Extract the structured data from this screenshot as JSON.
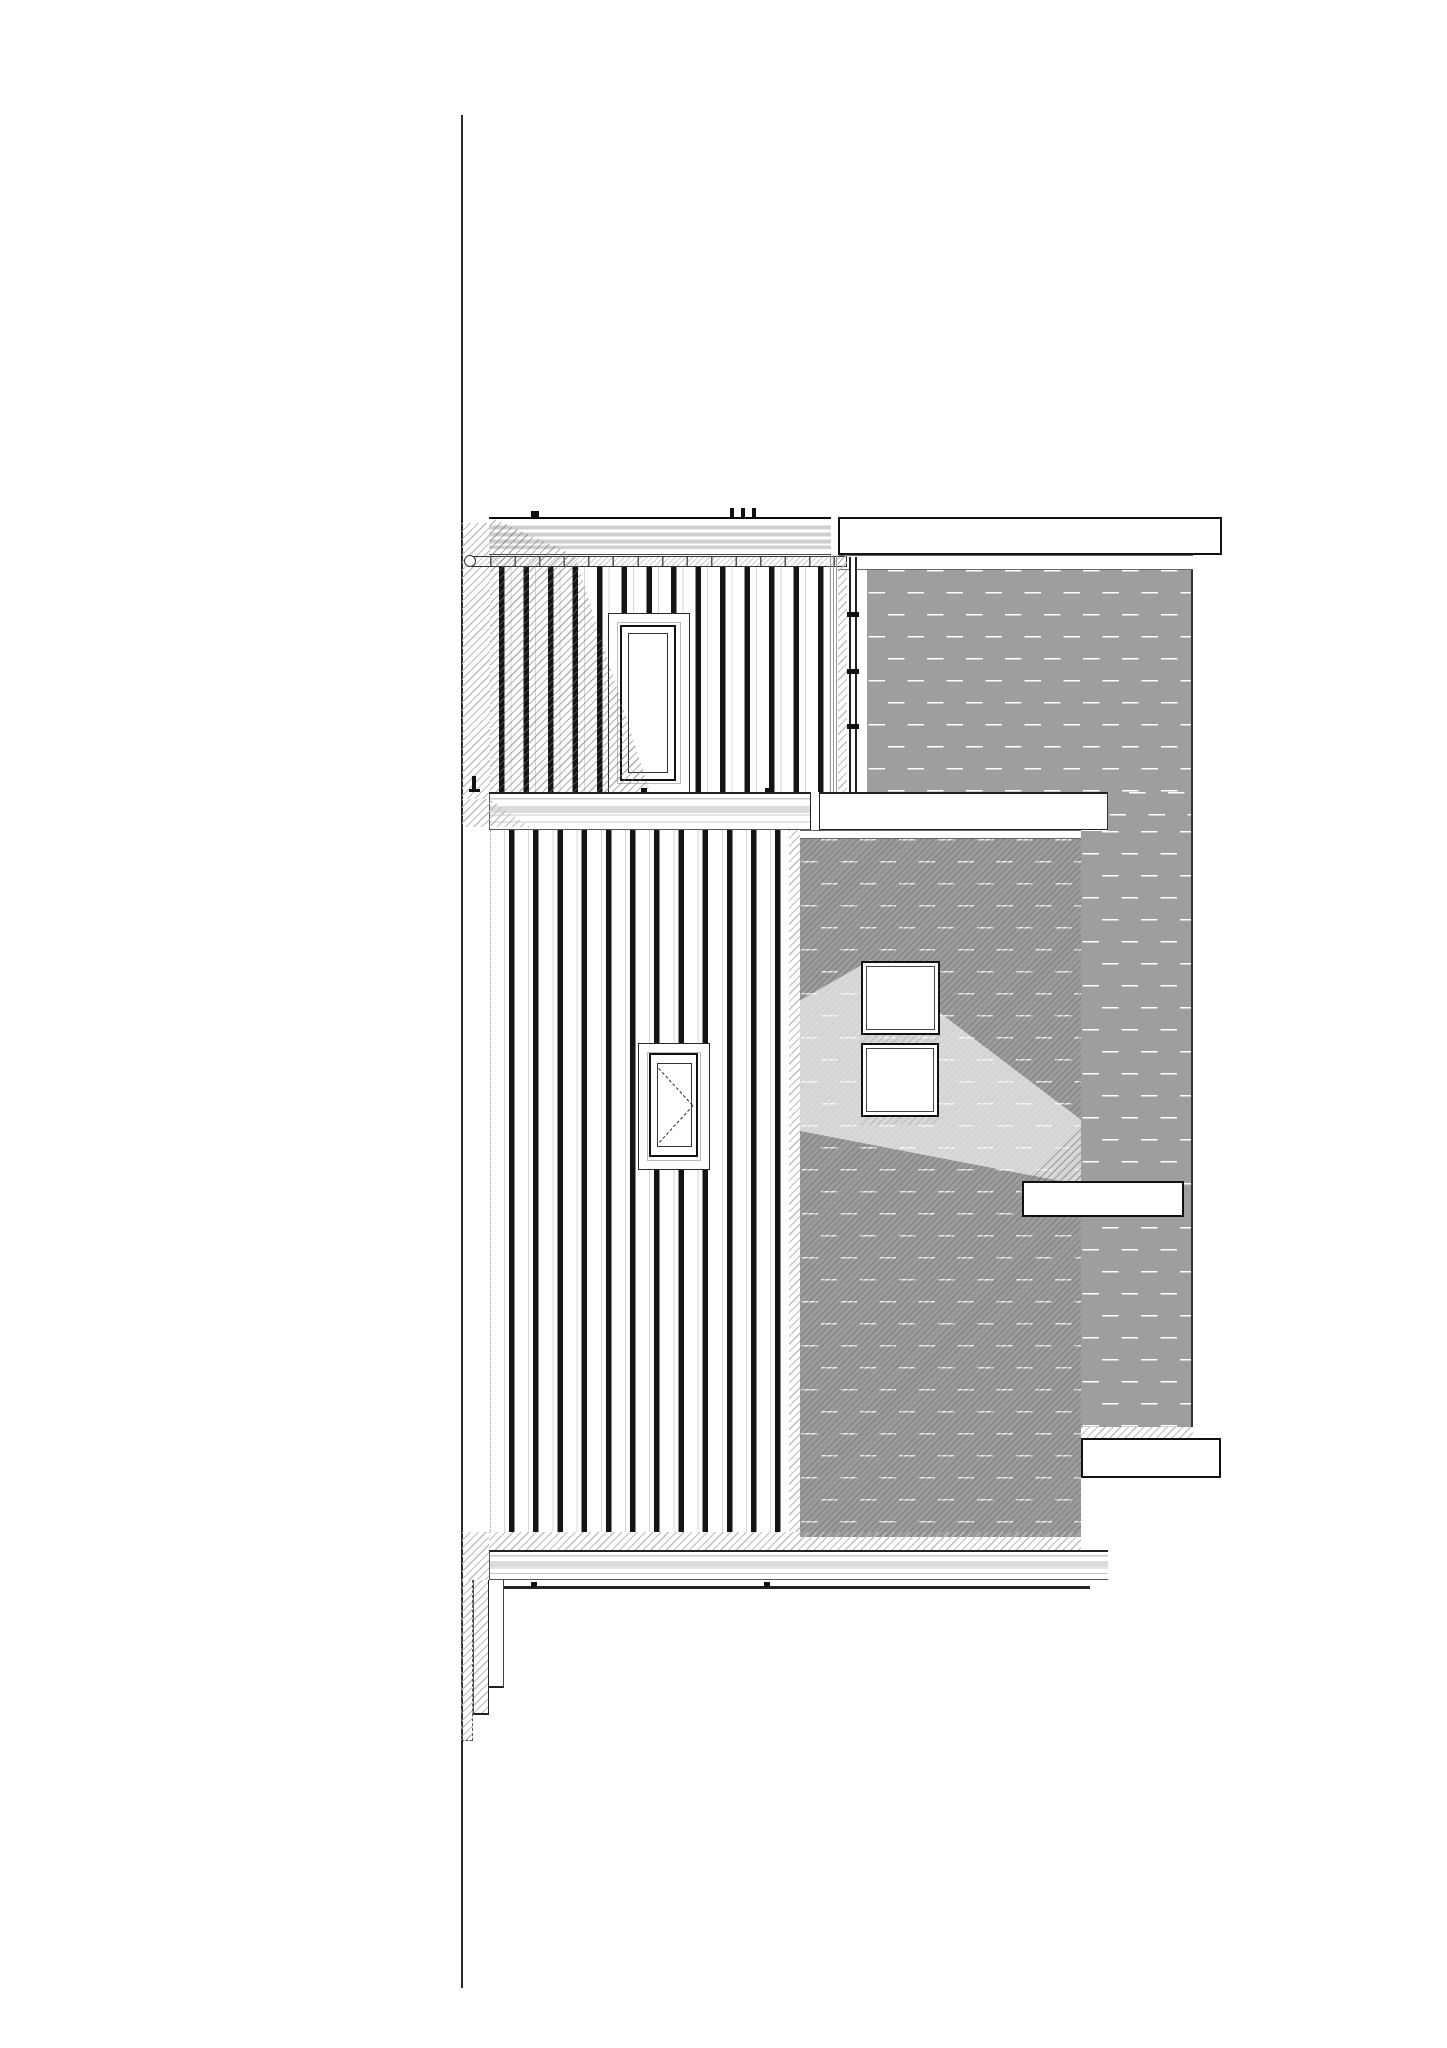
{
  "document": {
    "kind": "architectural-elevation-line-drawing",
    "text_content": [],
    "palette": {
      "paper": "#ffffff",
      "ink": "#111111",
      "shadow_hatch": "#bdbdbd",
      "rib_gray": "#cfcfcf",
      "brick_joint": "#9e9e9e"
    },
    "patterns": {
      "brick_bond": "vertical running bond",
      "brick_module_px": {
        "width": 19.5,
        "height": 44
      },
      "batten_spacing_px": {
        "upper": 24.55,
        "lower": 24.2
      },
      "hatch_direction": "bottom-left to top-right"
    }
  },
  "canvas": {
    "width": 1447,
    "height": 2048,
    "background": "#ffffff"
  },
  "elements": [
    {
      "name": "site-boundary-line",
      "cls": "vline",
      "x": 461,
      "y": 115,
      "w": 2,
      "h": 1873
    },
    {
      "name": "upper-parapet-fascia",
      "cls": "fascia",
      "x": 489,
      "y": 517,
      "w": 342,
      "h": 38
    },
    {
      "name": "fascia-top-tick",
      "cls": "tick",
      "x": 531,
      "y": 511,
      "w": 8,
      "h": 6
    },
    {
      "name": "fascia-top-dot-1",
      "cls": "tick",
      "x": 730,
      "y": 508,
      "w": 4,
      "h": 9
    },
    {
      "name": "fascia-top-dot-2",
      "cls": "tick",
      "x": 741,
      "y": 508,
      "w": 4,
      "h": 9
    },
    {
      "name": "fascia-top-dot-3",
      "cls": "tick",
      "x": 752,
      "y": 508,
      "w": 4,
      "h": 9
    },
    {
      "name": "right-parapet-capping",
      "cls": "band-plain",
      "x": 838,
      "y": 517,
      "w": 384,
      "h": 38
    },
    {
      "name": "right-parapet-strip",
      "cls": "strip",
      "x": 838,
      "y": 555,
      "w": 355,
      "h": 15
    },
    {
      "name": "upper-wall-left-shadow",
      "cls": "hatch",
      "x": 462,
      "y": 523,
      "w": 28,
      "h": 276
    },
    {
      "name": "upper-cladding-battens",
      "cls": "battens battens-up",
      "x": 490,
      "y": 566,
      "w": 340,
      "h": 226
    },
    {
      "name": "handrail",
      "cls": "rail",
      "x": 470,
      "y": 556,
      "w": 377,
      "h": 11
    },
    {
      "name": "handrail-end-cap",
      "cls": "rail-cap",
      "x": 464,
      "y": 555,
      "w": 12,
      "h": 12
    },
    {
      "name": "upper-window-surround",
      "cls": "win-surround",
      "x": 608,
      "y": 613,
      "w": 82,
      "h": 180
    },
    {
      "name": "upper-window-frame",
      "cls": "win-frame",
      "x": 620,
      "y": 625,
      "w": 56,
      "h": 156
    },
    {
      "name": "upper-window-glass",
      "cls": "win-glass",
      "x": 628,
      "y": 633,
      "w": 40,
      "h": 140
    },
    {
      "name": "upper-cast-shadow",
      "cls": "shadow poly-a",
      "x": 490,
      "y": 517,
      "w": 160,
      "h": 275
    },
    {
      "name": "upper-corner-trim",
      "cls": "vstripes",
      "x": 830,
      "y": 555,
      "w": 8,
      "h": 237
    },
    {
      "name": "upper-corner-shadow",
      "cls": "hatch",
      "x": 838,
      "y": 555,
      "w": 9,
      "h": 237
    },
    {
      "name": "rainwater-downpipe",
      "cls": "pipe",
      "x": 849,
      "y": 557,
      "w": 8,
      "h": 235
    },
    {
      "name": "downpipe-bracket-1",
      "cls": "bracket",
      "x": 847,
      "y": 612,
      "w": 12,
      "h": 5
    },
    {
      "name": "downpipe-bracket-2",
      "cls": "bracket",
      "x": 847,
      "y": 669,
      "w": 12,
      "h": 5
    },
    {
      "name": "downpipe-bracket-3",
      "cls": "bracket",
      "x": 847,
      "y": 724,
      "w": 12,
      "h": 5
    },
    {
      "name": "upper-brick-wall",
      "cls": "brick edge-r",
      "x": 867,
      "y": 570,
      "w": 326,
      "h": 222
    },
    {
      "name": "brick-pier-upper",
      "cls": "brick edge-r",
      "x": 1108,
      "y": 792,
      "w": 85,
      "h": 39
    },
    {
      "name": "brick-pier",
      "cls": "brick edge-r",
      "x": 1081,
      "y": 831,
      "w": 112,
      "h": 596
    },
    {
      "name": "lower-brick-wall",
      "cls": "brick brick-dark",
      "x": 800,
      "y": 839,
      "w": 281,
      "h": 698
    },
    {
      "name": "brick-light-patch",
      "cls": "highlight",
      "x": 800,
      "y": 960,
      "w": 281,
      "h": 225
    },
    {
      "name": "lower-brick-corner-shadow",
      "cls": "hatch",
      "x": 789,
      "y": 830,
      "w": 11,
      "h": 702
    },
    {
      "name": "first-floor-band",
      "cls": "band-ribbed",
      "x": 489,
      "y": 792,
      "w": 331,
      "h": 38
    },
    {
      "name": "first-floor-band-right",
      "cls": "band-plain2",
      "x": 820,
      "y": 792,
      "w": 288,
      "h": 38
    },
    {
      "name": "band-corner-joint",
      "cls": "joint",
      "x": 810,
      "y": 792,
      "w": 10,
      "h": 38
    },
    {
      "name": "band-shadow-wedge",
      "cls": "hatch wedge",
      "x": 462,
      "y": 799,
      "w": 68,
      "h": 28
    },
    {
      "name": "band-under-strip",
      "cls": "strip",
      "x": 800,
      "y": 830,
      "w": 281,
      "h": 9
    },
    {
      "name": "band-top-tick-1",
      "cls": "tick",
      "x": 641,
      "y": 788,
      "w": 6,
      "h": 4
    },
    {
      "name": "band-top-tick-2",
      "cls": "tick",
      "x": 765,
      "y": 788,
      "w": 6,
      "h": 4
    },
    {
      "name": "terrace-post",
      "cls": "tick",
      "x": 472,
      "y": 776,
      "w": 4,
      "h": 16
    },
    {
      "name": "terrace-post-foot",
      "cls": "tick",
      "x": 469,
      "y": 789,
      "w": 11,
      "h": 3
    },
    {
      "name": "lower-cladding-battens",
      "cls": "battens battens-low",
      "x": 490,
      "y": 830,
      "w": 299,
      "h": 702
    },
    {
      "name": "lower-window-surround",
      "cls": "win-surround",
      "x": 638,
      "y": 1043,
      "w": 72,
      "h": 127
    },
    {
      "name": "lower-window-frame",
      "cls": "win-frame",
      "x": 649,
      "y": 1053,
      "w": 49,
      "h": 104
    },
    {
      "name": "lower-window-glass",
      "cls": "win-glass",
      "x": 657,
      "y": 1063,
      "w": 35,
      "h": 84
    },
    {
      "name": "casement-dash-upper",
      "cls": "dashline rot-dn",
      "x": 659,
      "y": 1068,
      "w": 50,
      "h": 2
    },
    {
      "name": "casement-dash-lower",
      "cls": "dashline rot-up",
      "x": 659,
      "y": 1142,
      "w": 50,
      "h": 2
    },
    {
      "name": "brick-window-1",
      "cls": "sq-window",
      "x": 861,
      "y": 961,
      "w": 79,
      "h": 74
    },
    {
      "name": "window-sill-band-1",
      "cls": "hatch",
      "x": 861,
      "y": 1035,
      "w": 79,
      "h": 8
    },
    {
      "name": "brick-window-2",
      "cls": "sq-window",
      "x": 861,
      "y": 1043,
      "w": 78,
      "h": 74
    },
    {
      "name": "window-sill-band-2",
      "cls": "hatch",
      "x": 861,
      "y": 1117,
      "w": 78,
      "h": 8
    },
    {
      "name": "inset-band-shadow",
      "cls": "shadow tri",
      "x": 1022,
      "y": 1125,
      "w": 59,
      "h": 56
    },
    {
      "name": "inset-concrete-band",
      "cls": "band-plain",
      "x": 1022,
      "y": 1181,
      "w": 162,
      "h": 36
    },
    {
      "name": "pier-sill",
      "cls": "hatch",
      "x": 1081,
      "y": 1427,
      "w": 112,
      "h": 11
    },
    {
      "name": "lower-right-band",
      "cls": "band-plain",
      "x": 1081,
      "y": 1438,
      "w": 140,
      "h": 40
    },
    {
      "name": "base-shadow-strip",
      "cls": "hatch",
      "x": 489,
      "y": 1532,
      "w": 592,
      "h": 18
    },
    {
      "name": "base-left-hatch",
      "cls": "hatch",
      "x": 462,
      "y": 1532,
      "w": 27,
      "h": 48
    },
    {
      "name": "ground-floor-band",
      "cls": "band-ribbed",
      "x": 489,
      "y": 1550,
      "w": 619,
      "h": 30
    },
    {
      "name": "ground-line",
      "cls": "gline",
      "x": 490,
      "y": 1586,
      "w": 600,
      "h": 3
    },
    {
      "name": "ground-tick-1",
      "cls": "tick",
      "x": 531,
      "y": 1582,
      "w": 6,
      "h": 5
    },
    {
      "name": "ground-tick-2",
      "cls": "tick",
      "x": 764,
      "y": 1582,
      "w": 6,
      "h": 5
    },
    {
      "name": "footing-step-outer",
      "cls": "hatch step-dashed",
      "x": 461,
      "y": 1580,
      "w": 12,
      "h": 161
    },
    {
      "name": "footing-step-mid",
      "cls": "hatch step-solid",
      "x": 473,
      "y": 1580,
      "w": 16,
      "h": 135
    },
    {
      "name": "footing-step-inner",
      "cls": "stepc",
      "x": 489,
      "y": 1580,
      "w": 15,
      "h": 108
    }
  ]
}
